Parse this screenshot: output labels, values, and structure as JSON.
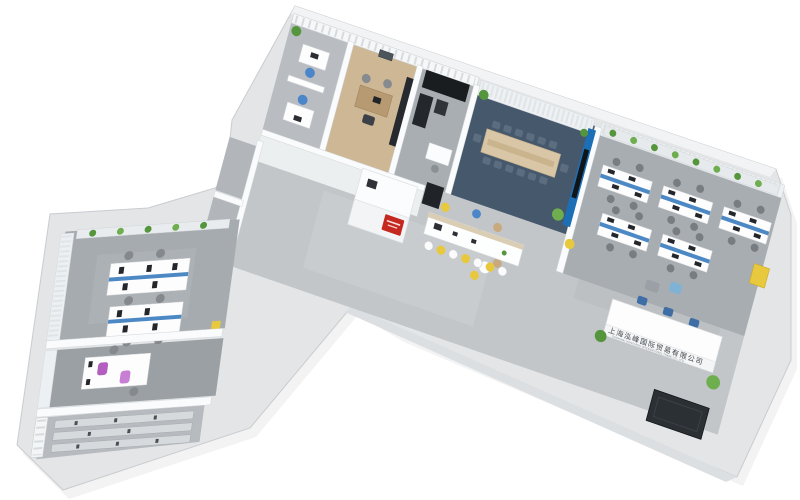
{
  "scene": {
    "description": "Isometric 3D rendering of an L-shaped office floor plan viewed from above on a white background",
    "background": "#ffffff"
  },
  "palette": {
    "wall": "#e3e5e7",
    "wall_edge": "#c9ccd0",
    "wall_top": "#f1f3f4",
    "floor": "#c2c6c9",
    "floor_dark": "#a9aeb2",
    "corridor": "#eceff0",
    "wood_floor": "#cdb795",
    "conference_carpet": "#46586c",
    "accent_blue": "#1d6fb5",
    "chair_blue": "#4a86c8",
    "desk_panel_blue": "#4c88c4",
    "accent_yellow": "#e8c83c",
    "accent_red": "#c4281f",
    "accent_purple": "#b35fc0",
    "plant_green": "#55953c",
    "plant_green_light": "#6fae4e",
    "dark_furniture": "#1a1d20",
    "doormat": "#2b3035",
    "white_furniture": "#fdfdfe",
    "table_wood": "#d8c6a6"
  },
  "reception_sign": {
    "chinese": "上海泓峰国际贸易有限公司",
    "english": "SHANGHAI HONGFENG INTERNATIONAL TRADE CO., LTD."
  },
  "rooms": [
    {
      "name": "corner-office",
      "furniture": [
        "desk",
        "blue-task-chairs",
        "lattice-partition",
        "plant"
      ]
    },
    {
      "name": "executive-office",
      "furniture": [
        "wood-desk",
        "black-bookshelf",
        "guest-chairs",
        "wall-picture"
      ]
    },
    {
      "name": "server-storage-room",
      "furniture": [
        "black-cabinets",
        "safe",
        "side-desk"
      ]
    },
    {
      "name": "conference-room",
      "furniture": [
        "long-table",
        "fourteen-chairs",
        "blue-presentation-wall",
        "curtains",
        "plants"
      ]
    },
    {
      "name": "open-office",
      "furniture": [
        "desk-clusters",
        "blue-privacy-panels",
        "task-chairs",
        "plant-shelf",
        "yellow-cabinet"
      ]
    },
    {
      "name": "reception-lobby",
      "furniture": [
        "reception-desk",
        "company-sign",
        "plants",
        "entrance-doormat",
        "lounge-chairs"
      ]
    },
    {
      "name": "pantry-bar",
      "furniture": [
        "island-counter",
        "bar-stools",
        "fridge",
        "cafe-tables"
      ]
    },
    {
      "name": "service-counter",
      "furniture": [
        "white-counter",
        "red-sign"
      ]
    },
    {
      "name": "utility-rooms",
      "furniture": []
    },
    {
      "name": "west-wing-office",
      "furniture": [
        "desk-pods",
        "monitors",
        "task-chairs",
        "plant-shelf",
        "curtains",
        "yellow-bin"
      ]
    },
    {
      "name": "west-wing-studio",
      "furniture": [
        "desks",
        "purple-chairs",
        "curtains"
      ]
    },
    {
      "name": "archive-storage",
      "furniture": [
        "shelving-racks",
        "windows"
      ]
    }
  ]
}
